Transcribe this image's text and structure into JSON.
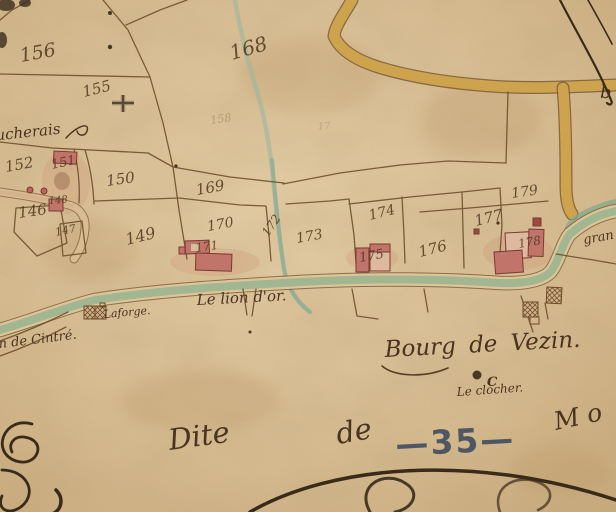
{
  "map": {
    "region_title": "Bourg de Vezin.",
    "sheet_number": "—35—"
  },
  "colors": {
    "parchment": "#d8bf97",
    "ink": "#5a4226",
    "stream_green": "#7fa98a",
    "road_yellow": "#d2a64e",
    "building_red": "#c0746a",
    "stamp_blue": "#3d4a5e"
  },
  "parcels": [
    {
      "n": "156"
    },
    {
      "n": "155"
    },
    {
      "n": "168"
    },
    {
      "n": "152"
    },
    {
      "n": "151"
    },
    {
      "n": "150"
    },
    {
      "n": "146"
    },
    {
      "n": "148"
    },
    {
      "n": "147"
    },
    {
      "n": "149"
    },
    {
      "n": "169"
    },
    {
      "n": "170"
    },
    {
      "n": "171"
    },
    {
      "n": "172"
    },
    {
      "n": "173"
    },
    {
      "n": "174"
    },
    {
      "n": "175"
    },
    {
      "n": "176"
    },
    {
      "n": "177"
    },
    {
      "n": "179"
    },
    {
      "n": "178"
    }
  ],
  "faint_numbers": [
    {
      "n": "158"
    },
    {
      "n": "17"
    }
  ],
  "places": {
    "hamlet": "ucherais",
    "laforge": "Laforge.",
    "lion_dor": "Le lion d'or.",
    "cintre": "in de Cintré.",
    "grande_route": "gran",
    "bourg": "Bourg de Vezin.",
    "clocher": "Le clocher.",
    "clocher_letter": "C",
    "edge_letter": "b"
  },
  "title_words": {
    "dite": "Dite",
    "de": "de",
    "number": "—35—",
    "mo": "M o"
  }
}
